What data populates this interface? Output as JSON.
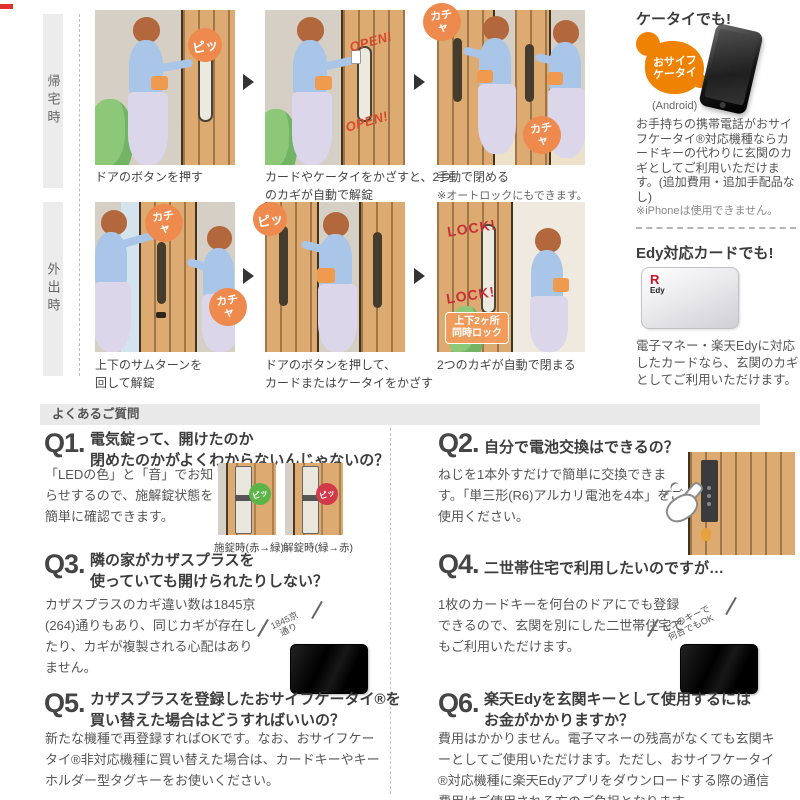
{
  "colors": {
    "accent_orange": "#ef8200",
    "bubble_orange": "#ef8a4f",
    "open_red": "#d6492e",
    "lock_red": "#c92f38",
    "led_green": "#5cb647",
    "led_red": "#d23a4a",
    "faq_bar_gray": "#e9e9e9"
  },
  "rows": {
    "homecoming": {
      "label": "帰宅時",
      "step1": {
        "bubble": "ピッ",
        "caption": "ドアのボタンを押す"
      },
      "step2": {
        "overlay": "OPEN!",
        "caption_l1": "カードやケータイをかざすと、2つ",
        "caption_l2": "のカギが自動で解錠"
      },
      "step3": {
        "bubble": "カチャ",
        "caption": "手動で閉める",
        "note": "※オートロックにもできます。"
      }
    },
    "going_out": {
      "label": "外出時",
      "step1": {
        "bubble": "カチャ",
        "caption_l1": "上下のサムターンを",
        "caption_l2": "回して解錠"
      },
      "step2": {
        "bubble": "ピッ",
        "caption_l1": "ドアのボタンを押して、",
        "caption_l2": "カードまたはケータイをかざす"
      },
      "step3": {
        "overlay": "LOCK!",
        "badge_l1": "上下2ヶ所",
        "badge_l2": "同時ロック",
        "caption": "2つのカギが自動で閉まる"
      }
    }
  },
  "aside": {
    "mobile": {
      "heading": "ケータイでも!",
      "logo_l1": "おサイフ",
      "logo_l2": "ケータイ",
      "platform": "(Android)",
      "body": "お手持ちの携帯電話がおサイフケータイ®対応機種ならカードキーの代わりに玄関のカギとしてご利用いただけます。(追加費用・追加手配品なし)",
      "note": "※iPhoneは使用できません。"
    },
    "edy": {
      "heading": "Edy対応カードでも!",
      "logo_r": "R",
      "logo_edy": "Edy",
      "body": "電子マネー・楽天Edyに対応したカードなら、玄関のカギとしてご利用いただけます。"
    }
  },
  "faq": {
    "header": "よくあるご質問",
    "q1": {
      "num": "Q1.",
      "q_l1": "電気錠って、開けたのか",
      "q_l2": "閉めたのかがよくわからないんじゃないの？",
      "answer": "「LEDの色」と「音」でお知らせするので、施解錠状態を簡単に確認できます。",
      "led_text": "ピッ",
      "cap_lock": "施錠時(赤→緑)",
      "cap_unlock": "解錠時(緑→赤)"
    },
    "q2": {
      "num": "Q2.",
      "q": "自分で電池交換はできるの？",
      "answer": "ねじを1本外すだけで簡単に交換できます。「単三形(R6)アルカリ電池を4本」をご使用ください。"
    },
    "q3": {
      "num": "Q3.",
      "q_l1": "隣の家がカザスプラスを",
      "q_l2": "使っていても開けられたりしない？",
      "answer": "カザスプラスのカギ違い数は1845京(264)通りもあり、同じカギが存在したり、カギが複製される心配はありません。",
      "label_l1": "1845京",
      "label_l2": "通り"
    },
    "q4": {
      "num": "Q4.",
      "q": "二世帯住宅で利用したいのですが…",
      "answer": "1枚のカードキーを何台のドアにでも登録できるので、玄関を別にした二世帯住宅でもご利用いただけます。",
      "label_l1": "1つのキーで",
      "label_l2": "何台でもOK"
    },
    "q5": {
      "num": "Q5.",
      "q_l1": "カザスプラスを登録したおサイフケータイ®を",
      "q_l2": "買い替えた場合はどうすればいいの？",
      "answer": "新たな機種で再登録すればOKです。なお、おサイフケータイ®非対応機種に買い替えた場合は、カードキーやキーホルダー型タグキーをお使いください。"
    },
    "q6": {
      "num": "Q6.",
      "q_l1": "楽天Edyを玄関キーとして使用するには",
      "q_l2": "お金がかかりますか？",
      "answer": "費用はかかりません。電子マネーの残高がなくても玄関キーとしてご使用いただけます。ただし、おサイフケータイ®対応機種に楽天Edyアプリをダウンロードする際の通信費用はご使用される方のご負担となります。"
    }
  }
}
